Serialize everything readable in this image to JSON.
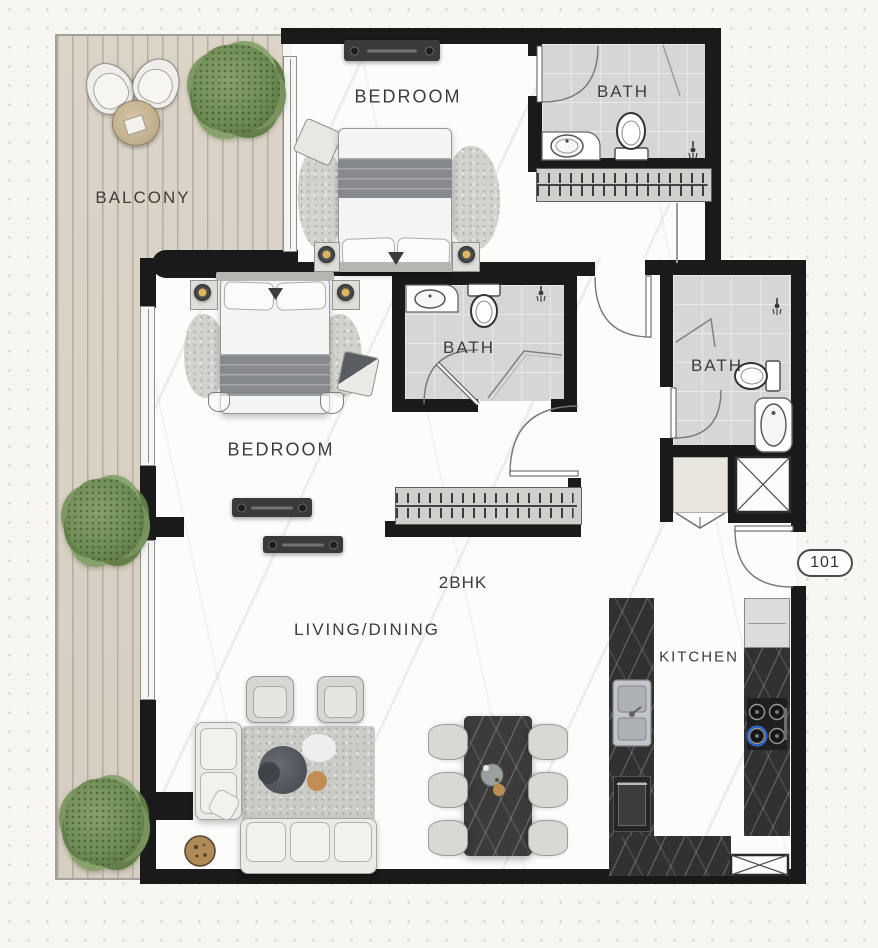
{
  "plan": {
    "unit_number": "101",
    "unit_type": "2BHK",
    "labels": {
      "balcony": "BALCONY",
      "bedroom_top": "BEDROOM",
      "bath_top": "BATH",
      "bedroom_mid": "BEDROOM",
      "bath_mid": "BATH",
      "bath_right": "BATH",
      "living_dining": "LIVING/DINING",
      "kitchen": "KITCHEN"
    },
    "colors": {
      "wall": "#1a1a1a",
      "floor": "#fcfcfb",
      "balcony_wood": "#d8d1c4",
      "bath_tile": "#d6d6d5",
      "kitchen_counter": "#313131",
      "accent_gold": "#c49a56",
      "plant_green": "#6f8b58",
      "stove_burner_blue": "#2f6bd8",
      "background": "#f7f6f3"
    }
  }
}
